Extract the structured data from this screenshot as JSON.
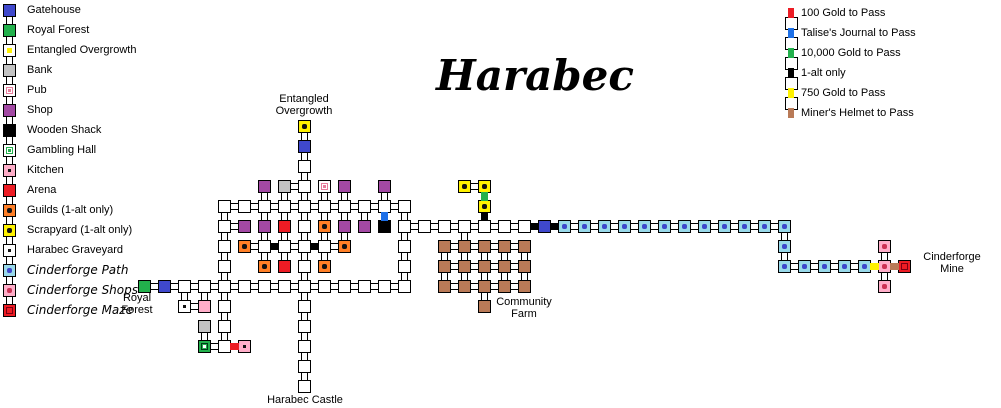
{
  "title": "Harabec",
  "colors": {
    "red": "#ED1C24",
    "blue": "#1D70E8",
    "green": "#22B14C",
    "black": "#000000",
    "yellow": "#FFF200",
    "brown": "#B97A57"
  },
  "legend_left": {
    "items": [
      {
        "label": "Gatehouse",
        "type": "gate",
        "fancy": false
      },
      {
        "label": "Royal Forest",
        "type": "forest",
        "fancy": false
      },
      {
        "label": "Entangled Overgrowth",
        "type": "eoL",
        "fancy": false
      },
      {
        "label": "Bank",
        "type": "bank",
        "fancy": false
      },
      {
        "label": "Pub",
        "type": "pub",
        "fancy": false
      },
      {
        "label": "Shop",
        "type": "shop",
        "fancy": false
      },
      {
        "label": "Wooden Shack",
        "type": "shack",
        "fancy": false
      },
      {
        "label": "Gambling Hall",
        "type": "gambleL",
        "fancy": false
      },
      {
        "label": "Kitchen",
        "type": "kitchen",
        "fancy": false
      },
      {
        "label": "Arena",
        "type": "arena",
        "fancy": false
      },
      {
        "label": "Guilds (1-alt only)",
        "type": "guild",
        "fancy": false
      },
      {
        "label": "Scrapyard (1-alt only)",
        "type": "scrap",
        "fancy": false
      },
      {
        "label": "Harabec Graveyard",
        "type": "grave",
        "fancy": false
      },
      {
        "label": "Cinderforge Path",
        "type": "path",
        "fancy": true
      },
      {
        "label": "Cinderforge Shops",
        "type": "shops",
        "fancy": true
      },
      {
        "label": "Cinderforge Maze",
        "type": "maze",
        "fancy": true
      }
    ]
  },
  "legend_right": {
    "items": [
      {
        "label": "100 Gold to Pass",
        "color": "red"
      },
      {
        "label": "Talise's Journal to Pass",
        "color": "blue"
      },
      {
        "label": "10,000 Gold to Pass",
        "color": "green"
      },
      {
        "label": "1-alt only",
        "color": "black"
      },
      {
        "label": "750 Gold to Pass",
        "color": "yellow"
      },
      {
        "label": "Miner's Helmet to Pass",
        "color": "brown"
      }
    ]
  },
  "map": {
    "grid": {
      "ox": 138,
      "oy": 120,
      "pitch": 20
    },
    "labels": [
      {
        "id": "entangled-overgrowth-label",
        "text": "Entangled\nOvergrowth",
        "cx": 304,
        "top": 93
      },
      {
        "id": "royal-forest-label",
        "text": "Royal\nForest",
        "cx": 137,
        "top": 292
      },
      {
        "id": "harabec-castle-label",
        "text": "Harabec Castle",
        "cx": 305,
        "top": 394
      },
      {
        "id": "community-farm-label",
        "text": "Community\nFarm",
        "cx": 524,
        "top": 296
      },
      {
        "id": "cinderforge-mine-label",
        "text": "Cinderforge\nMine",
        "cx": 952,
        "top": 251
      }
    ],
    "rooms": [
      [
        8,
        0,
        "eo"
      ],
      [
        8,
        1,
        "gate"
      ],
      [
        8,
        2,
        "p"
      ],
      [
        6,
        3,
        "shop"
      ],
      [
        7,
        3,
        "bank"
      ],
      [
        8,
        3,
        "p"
      ],
      [
        9,
        3,
        "pub"
      ],
      [
        10,
        3,
        "shop"
      ],
      [
        12,
        3,
        "shop"
      ],
      [
        16,
        3,
        "scrap"
      ],
      [
        17,
        3,
        "scrap"
      ],
      [
        4,
        4,
        "p"
      ],
      [
        5,
        4,
        "p"
      ],
      [
        6,
        4,
        "p"
      ],
      [
        7,
        4,
        "p"
      ],
      [
        8,
        4,
        "p"
      ],
      [
        9,
        4,
        "p"
      ],
      [
        10,
        4,
        "p"
      ],
      [
        11,
        4,
        "p"
      ],
      [
        12,
        4,
        "p"
      ],
      [
        13,
        4,
        "p"
      ],
      [
        17,
        4,
        "scrap"
      ],
      [
        4,
        5,
        "p"
      ],
      [
        5,
        5,
        "shop"
      ],
      [
        6,
        5,
        "shop"
      ],
      [
        7,
        5,
        "arena"
      ],
      [
        8,
        5,
        "p"
      ],
      [
        9,
        5,
        "guild"
      ],
      [
        10,
        5,
        "shop"
      ],
      [
        11,
        5,
        "shop"
      ],
      [
        12,
        5,
        "shack"
      ],
      [
        13,
        5,
        "p"
      ],
      [
        14,
        5,
        "p"
      ],
      [
        15,
        5,
        "p"
      ],
      [
        16,
        5,
        "p"
      ],
      [
        17,
        5,
        "p"
      ],
      [
        18,
        5,
        "p"
      ],
      [
        19,
        5,
        "p"
      ],
      [
        20,
        5,
        "gate"
      ],
      [
        21,
        5,
        "path"
      ],
      [
        22,
        5,
        "path"
      ],
      [
        23,
        5,
        "path"
      ],
      [
        24,
        5,
        "path"
      ],
      [
        25,
        5,
        "path"
      ],
      [
        26,
        5,
        "path"
      ],
      [
        27,
        5,
        "path"
      ],
      [
        28,
        5,
        "path"
      ],
      [
        29,
        5,
        "path"
      ],
      [
        30,
        5,
        "path"
      ],
      [
        31,
        5,
        "path"
      ],
      [
        32,
        5,
        "path"
      ],
      [
        4,
        6,
        "p"
      ],
      [
        5,
        6,
        "guild"
      ],
      [
        6,
        6,
        "p"
      ],
      [
        7,
        6,
        "p"
      ],
      [
        8,
        6,
        "p"
      ],
      [
        9,
        6,
        "p"
      ],
      [
        10,
        6,
        "guild"
      ],
      [
        13,
        6,
        "p"
      ],
      [
        15,
        6,
        "farm"
      ],
      [
        16,
        6,
        "farm"
      ],
      [
        17,
        6,
        "farm"
      ],
      [
        18,
        6,
        "farm"
      ],
      [
        19,
        6,
        "farm"
      ],
      [
        32,
        6,
        "path"
      ],
      [
        37,
        6,
        "shops"
      ],
      [
        4,
        7,
        "p"
      ],
      [
        6,
        7,
        "guild"
      ],
      [
        7,
        7,
        "arena"
      ],
      [
        8,
        7,
        "p"
      ],
      [
        9,
        7,
        "guild"
      ],
      [
        13,
        7,
        "p"
      ],
      [
        15,
        7,
        "farm"
      ],
      [
        16,
        7,
        "farm"
      ],
      [
        17,
        7,
        "farm"
      ],
      [
        18,
        7,
        "farm"
      ],
      [
        19,
        7,
        "farm"
      ],
      [
        32,
        7,
        "path"
      ],
      [
        33,
        7,
        "path"
      ],
      [
        34,
        7,
        "path"
      ],
      [
        35,
        7,
        "path"
      ],
      [
        36,
        7,
        "path"
      ],
      [
        37,
        7,
        "shops"
      ],
      [
        38,
        7,
        "maze"
      ],
      [
        0,
        8,
        "forest"
      ],
      [
        1,
        8,
        "gate"
      ],
      [
        2,
        8,
        "p"
      ],
      [
        3,
        8,
        "p"
      ],
      [
        4,
        8,
        "p"
      ],
      [
        5,
        8,
        "p"
      ],
      [
        6,
        8,
        "p"
      ],
      [
        7,
        8,
        "p"
      ],
      [
        8,
        8,
        "p"
      ],
      [
        9,
        8,
        "p"
      ],
      [
        10,
        8,
        "p"
      ],
      [
        11,
        8,
        "p"
      ],
      [
        12,
        8,
        "p"
      ],
      [
        13,
        8,
        "p"
      ],
      [
        15,
        8,
        "farm"
      ],
      [
        16,
        8,
        "farm"
      ],
      [
        17,
        8,
        "farm"
      ],
      [
        18,
        8,
        "farm"
      ],
      [
        19,
        8,
        "farm"
      ],
      [
        37,
        8,
        "shops"
      ],
      [
        2,
        9,
        "grave"
      ],
      [
        3,
        9,
        "pink"
      ],
      [
        4,
        9,
        "p"
      ],
      [
        8,
        9,
        "p"
      ],
      [
        17,
        9,
        "farm"
      ],
      [
        3,
        10,
        "bank"
      ],
      [
        4,
        10,
        "p"
      ],
      [
        8,
        10,
        "p"
      ],
      [
        3,
        11,
        "gamble"
      ],
      [
        4,
        11,
        "p"
      ],
      [
        5,
        11,
        "kitchen"
      ],
      [
        8,
        11,
        "p"
      ],
      [
        8,
        12,
        "p"
      ],
      [
        8,
        13,
        "p"
      ]
    ],
    "links": {
      "v": [
        [
          8,
          0
        ],
        [
          8,
          1
        ],
        [
          8,
          2
        ],
        [
          8,
          3
        ],
        [
          8,
          4
        ],
        [
          8,
          5
        ],
        [
          8,
          6
        ],
        [
          8,
          7
        ],
        [
          8,
          8
        ],
        [
          8,
          9
        ],
        [
          8,
          10
        ],
        [
          8,
          11
        ],
        [
          8,
          12
        ],
        [
          6,
          3
        ],
        [
          7,
          3
        ],
        [
          9,
          3
        ],
        [
          10,
          3
        ],
        [
          12,
          3
        ],
        [
          4,
          4
        ],
        [
          6,
          4
        ],
        [
          7,
          4
        ],
        [
          9,
          4
        ],
        [
          10,
          4
        ],
        [
          11,
          4
        ],
        [
          13,
          4
        ],
        [
          4,
          5
        ],
        [
          6,
          5
        ],
        [
          7,
          5
        ],
        [
          9,
          5
        ],
        [
          10,
          5
        ],
        [
          13,
          5
        ],
        [
          16,
          5
        ],
        [
          32,
          5
        ],
        [
          4,
          6
        ],
        [
          6,
          6
        ],
        [
          7,
          6
        ],
        [
          9,
          6
        ],
        [
          13,
          6
        ],
        [
          15,
          6
        ],
        [
          16,
          6
        ],
        [
          17,
          6
        ],
        [
          18,
          6
        ],
        [
          19,
          6
        ],
        [
          32,
          6
        ],
        [
          37,
          6
        ],
        [
          4,
          7
        ],
        [
          13,
          7
        ],
        [
          15,
          7
        ],
        [
          16,
          7
        ],
        [
          17,
          7
        ],
        [
          18,
          7
        ],
        [
          19,
          7
        ],
        [
          37,
          7
        ],
        [
          2,
          8
        ],
        [
          3,
          8
        ],
        [
          4,
          8
        ],
        [
          17,
          8
        ],
        [
          4,
          9
        ],
        [
          3,
          10
        ],
        [
          4,
          10
        ]
      ],
      "h": [
        [
          7,
          3
        ],
        [
          16,
          3
        ],
        [
          4,
          4
        ],
        [
          5,
          4
        ],
        [
          6,
          4
        ],
        [
          7,
          4
        ],
        [
          8,
          4
        ],
        [
          9,
          4
        ],
        [
          10,
          4
        ],
        [
          11,
          4
        ],
        [
          12,
          4
        ],
        [
          4,
          5
        ],
        [
          13,
          5
        ],
        [
          14,
          5
        ],
        [
          15,
          5
        ],
        [
          16,
          5
        ],
        [
          17,
          5
        ],
        [
          18,
          5
        ],
        [
          21,
          5
        ],
        [
          22,
          5
        ],
        [
          23,
          5
        ],
        [
          24,
          5
        ],
        [
          25,
          5
        ],
        [
          26,
          5
        ],
        [
          27,
          5
        ],
        [
          28,
          5
        ],
        [
          29,
          5
        ],
        [
          30,
          5
        ],
        [
          31,
          5
        ],
        [
          5,
          6
        ],
        [
          7,
          6
        ],
        [
          9,
          6
        ],
        [
          15,
          6
        ],
        [
          16,
          6
        ],
        [
          17,
          6
        ],
        [
          18,
          6
        ],
        [
          15,
          7
        ],
        [
          16,
          7
        ],
        [
          17,
          7
        ],
        [
          18,
          7
        ],
        [
          32,
          7
        ],
        [
          33,
          7
        ],
        [
          34,
          7
        ],
        [
          35,
          7
        ],
        [
          0,
          8
        ],
        [
          1,
          8
        ],
        [
          2,
          8
        ],
        [
          3,
          8
        ],
        [
          4,
          8
        ],
        [
          5,
          8
        ],
        [
          6,
          8
        ],
        [
          7,
          8
        ],
        [
          8,
          8
        ],
        [
          9,
          8
        ],
        [
          10,
          8
        ],
        [
          11,
          8
        ],
        [
          12,
          8
        ],
        [
          15,
          8
        ],
        [
          16,
          8
        ],
        [
          17,
          8
        ],
        [
          18,
          8
        ],
        [
          2,
          9
        ],
        [
          3,
          11
        ]
      ]
    },
    "doors": [
      [
        12,
        4,
        "v",
        "blue"
      ],
      [
        17,
        3,
        "v",
        "green"
      ],
      [
        17,
        4,
        "v",
        "black"
      ],
      [
        19,
        5,
        "h",
        "black"
      ],
      [
        20,
        5,
        "h",
        "black"
      ],
      [
        6,
        6,
        "h",
        "black"
      ],
      [
        8,
        6,
        "h",
        "black"
      ],
      [
        36,
        7,
        "h",
        "yellow"
      ],
      [
        37,
        7,
        "h",
        "brown"
      ],
      [
        4,
        11,
        "h",
        "red"
      ]
    ]
  }
}
